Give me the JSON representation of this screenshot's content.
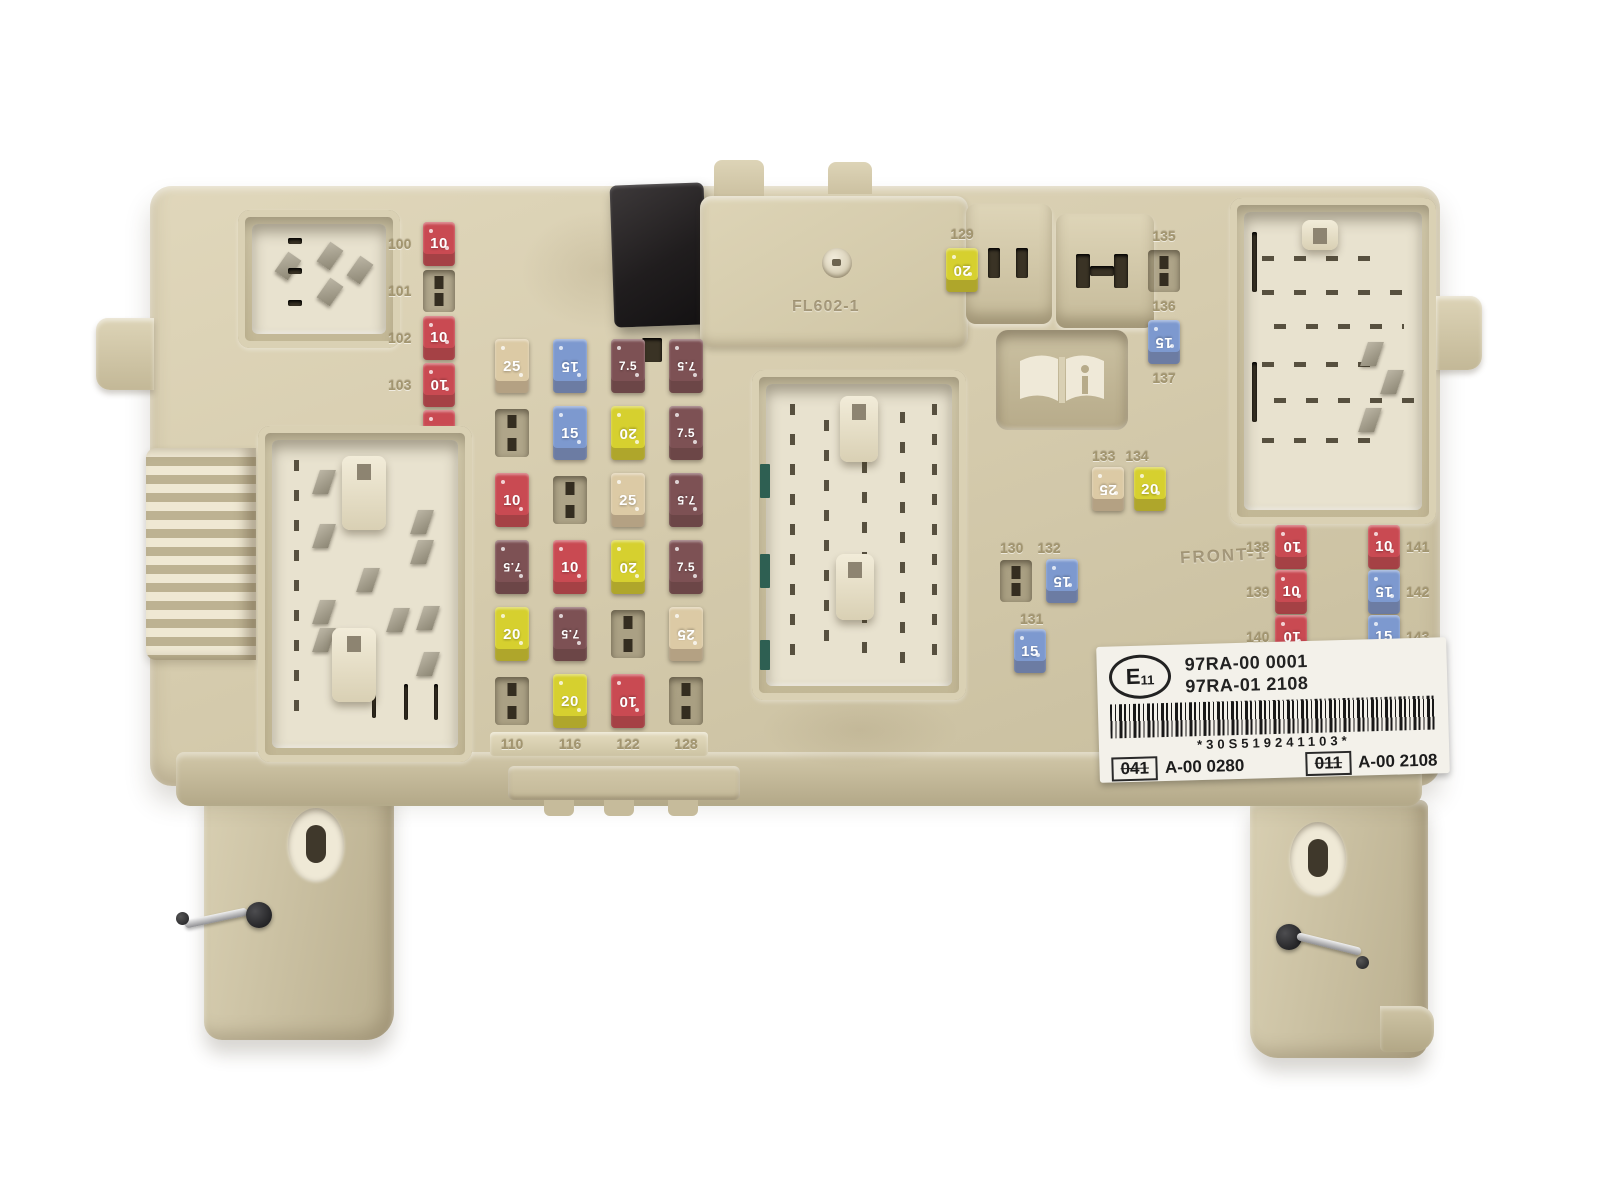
{
  "colors": {
    "background": "#ffffff",
    "housing": "#d7cdaf",
    "housing_shadow": "#b9ae8e",
    "recess": "#e8e2cf",
    "relay_black": "#221f20",
    "label_emboss": "#a2956f",
    "sticker_bg": "#f3f1ea",
    "sticker_ink": "#1c1c1c",
    "metal_pin": "#8d8775"
  },
  "fuse_colors": {
    "7.5": "#7d5154",
    "10": "#c94a52",
    "15": "#7d99cf",
    "20": "#d6d02f",
    "25": "#dccaa5"
  },
  "icons": {
    "manual_symbol": "open-book-icon",
    "approval_mark": "e-mark-oval-icon"
  },
  "molded_texts": {
    "cover_code": "FL602-1",
    "front_marking": "FRONT-1"
  },
  "sticker": {
    "e_mark_letter": "E",
    "e_mark_number": "11",
    "part_number_1": "97RA-00 0001",
    "part_number_2": "97RA-01 2108",
    "barcode_text": "*30S519241103*",
    "code_box_1": "041",
    "code_value_1": "A-00 0280",
    "code_box_2": "011",
    "code_value_2": "A-00 2108"
  },
  "clusters": {
    "left_column": {
      "slots": [
        {
          "label": "100",
          "amp": "10"
        },
        {
          "label": "101",
          "amp": null
        },
        {
          "label": "102",
          "amp": "10"
        },
        {
          "label": "103",
          "amp": "10"
        },
        {
          "label": "104",
          "amp": "10"
        }
      ]
    },
    "main_grid": {
      "columns": 4,
      "rows": 6,
      "column_bottom_labels": [
        "110",
        "116",
        "122",
        "128"
      ],
      "cells": [
        [
          "25",
          "15",
          "7.5",
          "7.5"
        ],
        [
          null,
          "15",
          "20",
          "7.5"
        ],
        [
          "10",
          null,
          "25",
          "7.5"
        ],
        [
          "7.5",
          "10",
          "20",
          "7.5"
        ],
        [
          "20",
          "7.5",
          null,
          "25"
        ],
        [
          null,
          "20",
          "10",
          null
        ]
      ]
    },
    "top_mid": {
      "slots": [
        {
          "label": "129",
          "amp": "20"
        }
      ]
    },
    "right_col_upper": {
      "slots": [
        {
          "label": "135",
          "amp": null
        },
        {
          "label": "136",
          "amp": "15"
        },
        {
          "label": "137",
          "amp": null
        }
      ]
    },
    "mid_right_pair": {
      "slots": [
        {
          "label": "130",
          "amp": null
        },
        {
          "label": "132",
          "amp": "15"
        },
        {
          "label": "131",
          "amp": "15"
        }
      ]
    },
    "mid_right_duo": {
      "slots": [
        {
          "label": "133",
          "amp": "25"
        },
        {
          "label": "134",
          "amp": "20"
        }
      ]
    },
    "bottom_right_left_col": {
      "slots": [
        {
          "label": "138",
          "amp": "10"
        },
        {
          "label": "139",
          "amp": "10"
        },
        {
          "label": "140",
          "amp": "10"
        }
      ]
    },
    "bottom_right_right_col": {
      "slots": [
        {
          "label": "141",
          "amp": "10"
        },
        {
          "label": "142",
          "amp": "15"
        },
        {
          "label": "143",
          "amp": "15"
        }
      ]
    }
  }
}
